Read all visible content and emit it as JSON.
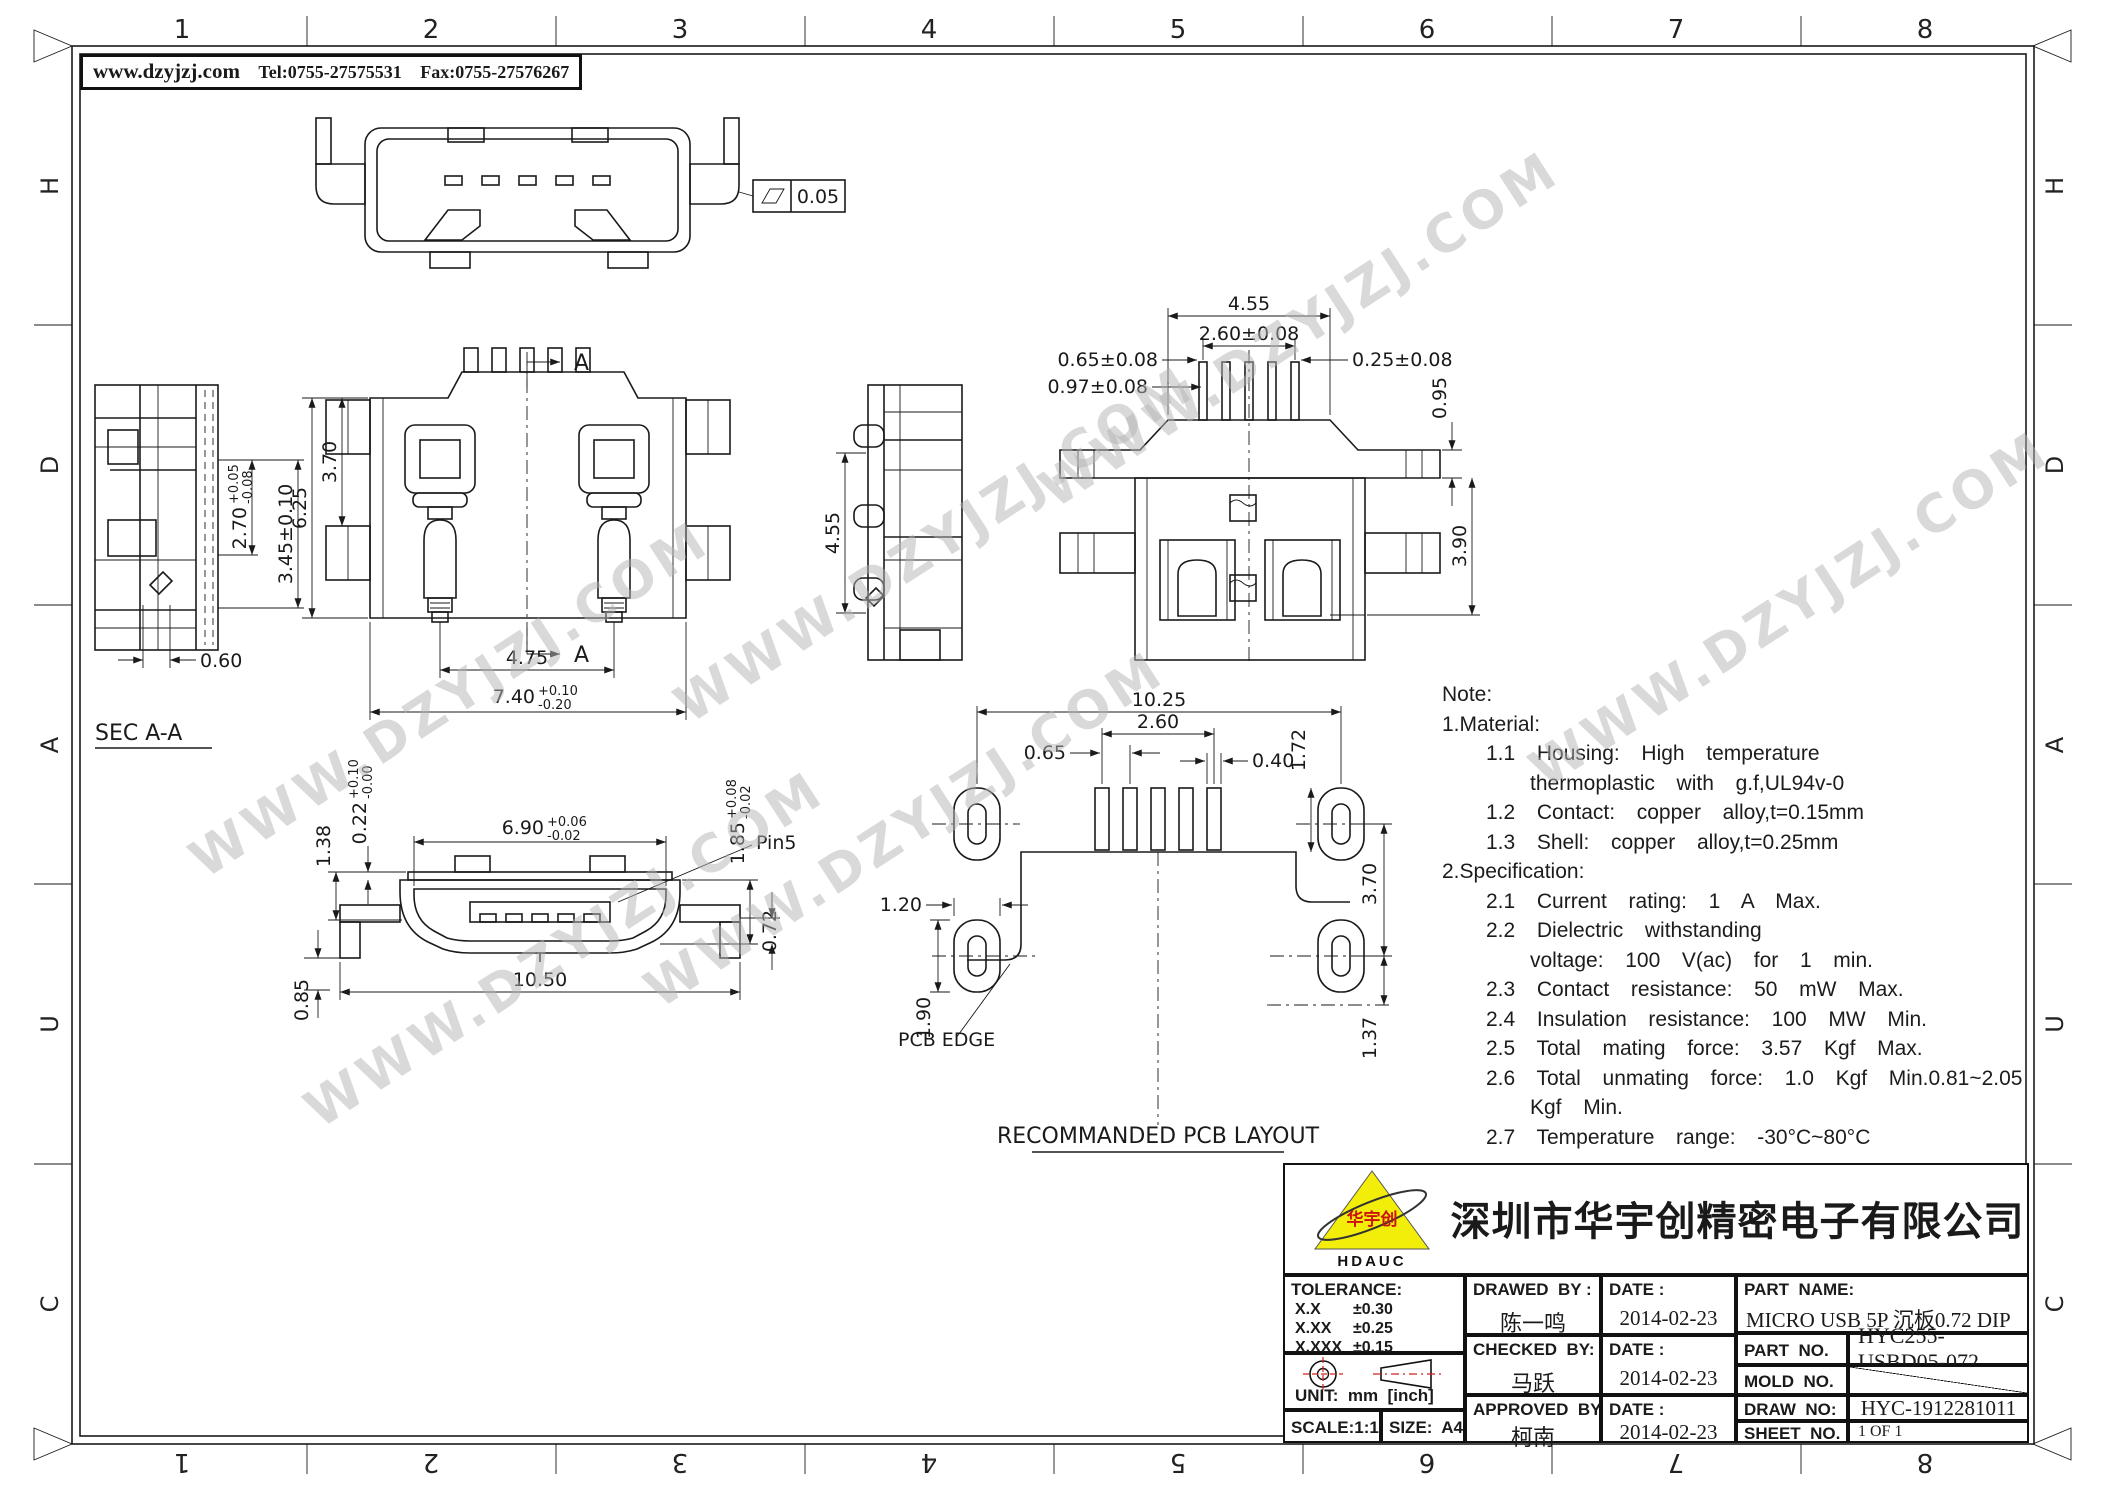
{
  "header": {
    "website": "www.dzyjzj.com",
    "tel": "Tel:0755-27575531",
    "fax": "Fax:0755-27576267"
  },
  "watermark": {
    "text": "WWW.DZYJZJ.COM"
  },
  "frame": {
    "columns": [
      "1",
      "2",
      "3",
      "4",
      "5",
      "6",
      "7",
      "8"
    ],
    "rows": [
      "H",
      "D",
      "A",
      "U",
      "C"
    ]
  },
  "views": {
    "top_view": {
      "flatness_value": "0.05"
    },
    "sec_aa": {
      "label": "SEC A-A",
      "dim_270": {
        "main": "2.70",
        "plus": "+0.05",
        "minus": "-0.08"
      },
      "dim_345": "3.45±0.10",
      "dim_060": "0.60"
    },
    "main_view": {
      "section_label": "A",
      "dim_625": "6.25",
      "dim_370": "3.70",
      "dim_475": "4.75",
      "dim_740": {
        "main": "7.40",
        "plus": "+0.10",
        "minus": "-0.20"
      }
    },
    "side_view": {
      "dim_455": "4.55"
    },
    "rear_view": {
      "dim_455": "4.55",
      "dim_260": "2.60±0.08",
      "dim_065": "0.65±0.08",
      "dim_097": "0.97±0.08",
      "dim_025": "0.25±0.08",
      "dim_095": "0.95",
      "dim_390": "3.90"
    },
    "front_view": {
      "pin_label": "Pin5",
      "dim_690": {
        "main": "6.90",
        "plus": "+0.06",
        "minus": "-0.02"
      },
      "dim_138": "1.38",
      "dim_022": {
        "main": "0.22",
        "plus": "+0.10",
        "minus": "-0.00"
      },
      "dim_185": {
        "main": "1.85",
        "plus": "+0.08",
        "minus": "-0.02"
      },
      "dim_072": "0.72",
      "dim_085": "0.85",
      "dim_1050": "10.50"
    },
    "pcb_layout": {
      "title": "RECOMMANDED PCB LAYOUT",
      "edge_label": "PCB EDGE",
      "dim_1025": "10.25",
      "dim_260": "2.60",
      "dim_065": "0.65",
      "dim_040": "0.40",
      "dim_172": "1.72",
      "dim_370": "3.70",
      "dim_137": "1.37",
      "dim_120": "1.20",
      "dim_190": "1.90"
    }
  },
  "notes": {
    "lines": [
      {
        "text": "Note:",
        "ind": 0
      },
      {
        "text": "1.Material:",
        "ind": 0
      },
      {
        "text": "1.1  Housing:  High  temperature",
        "ind": 1
      },
      {
        "text": "thermoplastic  with  g.f,UL94v-0",
        "ind": 2
      },
      {
        "text": "1.2  Contact:  copper  alloy,t=0.15mm",
        "ind": 1
      },
      {
        "text": "1.3  Shell:  copper  alloy,t=0.25mm",
        "ind": 1
      },
      {
        "text": "2.Specification:",
        "ind": 0
      },
      {
        "text": "2.1  Current  rating:  1  A  Max.",
        "ind": 1
      },
      {
        "text": "2.2  Dielectric  withstanding",
        "ind": 1
      },
      {
        "text": "voltage:  100  V(ac)  for  1  min.",
        "ind": 2
      },
      {
        "text": "2.3  Contact  resistance:  50  mW  Max.",
        "ind": 1
      },
      {
        "text": "2.4  Insulation  resistance:  100  MW  Min.",
        "ind": 1
      },
      {
        "text": "2.5  Total  mating  force:  3.57  Kgf  Max.",
        "ind": 1
      },
      {
        "text": "2.6  Total  unmating  force:  1.0  Kgf  Min.0.81~2.05",
        "ind": 1
      },
      {
        "text": "Kgf  Min.",
        "ind": 2
      },
      {
        "text": "2.7  Temperature  range:  -30°C~80°C",
        "ind": 1
      }
    ]
  },
  "title_block": {
    "logo": {
      "abbr": "HDAUC",
      "cn": "华宇创"
    },
    "company": "深圳市华宇创精密电子有限公司",
    "tolerance": {
      "label": "TOLERANCE:",
      "rows": [
        {
          "l": "X.X",
          "v": "±0.30"
        },
        {
          "l": "X.XX",
          "v": "±0.25"
        },
        {
          "l": "X.XXX",
          "v": "±0.15"
        }
      ],
      "angles": [
        {
          "l": "X.°",
          "v": "±2°"
        },
        {
          "l": "X.X°",
          "v": "±0.5°"
        }
      ]
    },
    "unit_label": "UNIT:  mm  [inch]",
    "scale": "SCALE:1:1",
    "size": "SIZE:  A4",
    "drawn": {
      "label": "DRAWED  BY :",
      "name": "陈一鸣",
      "date_label": "DATE :",
      "date": "2014-02-23"
    },
    "checked": {
      "label": "CHECKED  BY:",
      "name": "马跃",
      "date_label": "DATE :",
      "date": "2014-02-23"
    },
    "approved": {
      "label": "APPROVED  BY:",
      "name": "柯南",
      "date_label": "DATE :",
      "date": "2014-02-23"
    },
    "part_name": {
      "label": "PART  NAME:",
      "value": "MICRO USB 5P 沉板0.72 DIP无边"
    },
    "part_no": {
      "label": "PART  NO.",
      "value": "HYC255-USBD05-072"
    },
    "mold_no": {
      "label": "MOLD  NO."
    },
    "draw_no": {
      "label": "DRAW  NO:",
      "value": "HYC-1912281011"
    },
    "sheet_no": {
      "label": "SHEET  NO.",
      "value": "1 OF 1"
    }
  }
}
